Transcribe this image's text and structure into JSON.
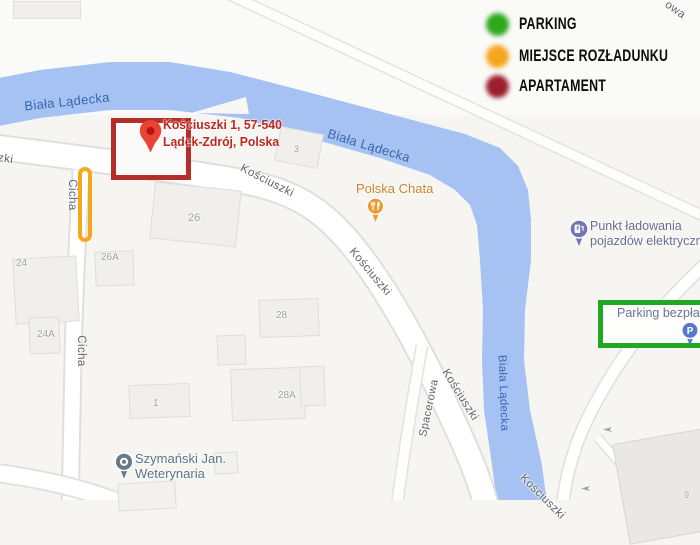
{
  "legend": {
    "items": [
      {
        "label": "PARKING",
        "color": "#2fa81e"
      },
      {
        "label": "MIEJSCE ROZŁADUNKU",
        "color": "#f6a51f"
      },
      {
        "label": "APARTAMENT",
        "color": "#9b1f2b"
      }
    ]
  },
  "destination": {
    "address_line1": "Kościuszki 1, 57-540",
    "address_line2": "Lądek-Zdrój, Polska",
    "pin_color": "#ea4335"
  },
  "annotations": {
    "apartment_box_color": "#b23029",
    "unloading_bar_color": "#f5a81c",
    "parking_box_color": "#22a722"
  },
  "map": {
    "water_color": "#a5c2f3",
    "river_labels": [
      {
        "text": "Biała Lądecka"
      },
      {
        "text": "Biała Lądecka"
      },
      {
        "text": "Biała Lądecka"
      }
    ],
    "street_labels": [
      {
        "text": "Kościuszki"
      },
      {
        "text": "Kościuszki"
      },
      {
        "text": "Kościuszki"
      },
      {
        "text": "Kościuszki"
      },
      {
        "text": "zki"
      },
      {
        "text": "Cicha"
      },
      {
        "text": "Cicha"
      },
      {
        "text": "Spacerowa"
      },
      {
        "text": "owa"
      }
    ],
    "building_labels": [
      {
        "text": "26"
      },
      {
        "text": "26A"
      },
      {
        "text": "24"
      },
      {
        "text": "24A"
      },
      {
        "text": "28"
      },
      {
        "text": "28A"
      },
      {
        "text": "1"
      },
      {
        "text": "3"
      },
      {
        "text": "9"
      }
    ],
    "pois": {
      "restaurant": {
        "name": "Polska Chata",
        "color": "#ef9a2e",
        "label_color": "#cd8428"
      },
      "ev_charging": {
        "line1": "Punkt ładowania",
        "line2": "pojazdów elektrycznych",
        "color": "#7176b4",
        "label_color": "#656e92"
      },
      "parking": {
        "name": "Parking bezpłatny",
        "color": "#5578cd",
        "label_color": "#68749b"
      },
      "vet": {
        "line1": "Szymański Jan.",
        "line2": "Weterynaria",
        "color": "#64798b",
        "label_color": "#5d7383"
      }
    }
  }
}
